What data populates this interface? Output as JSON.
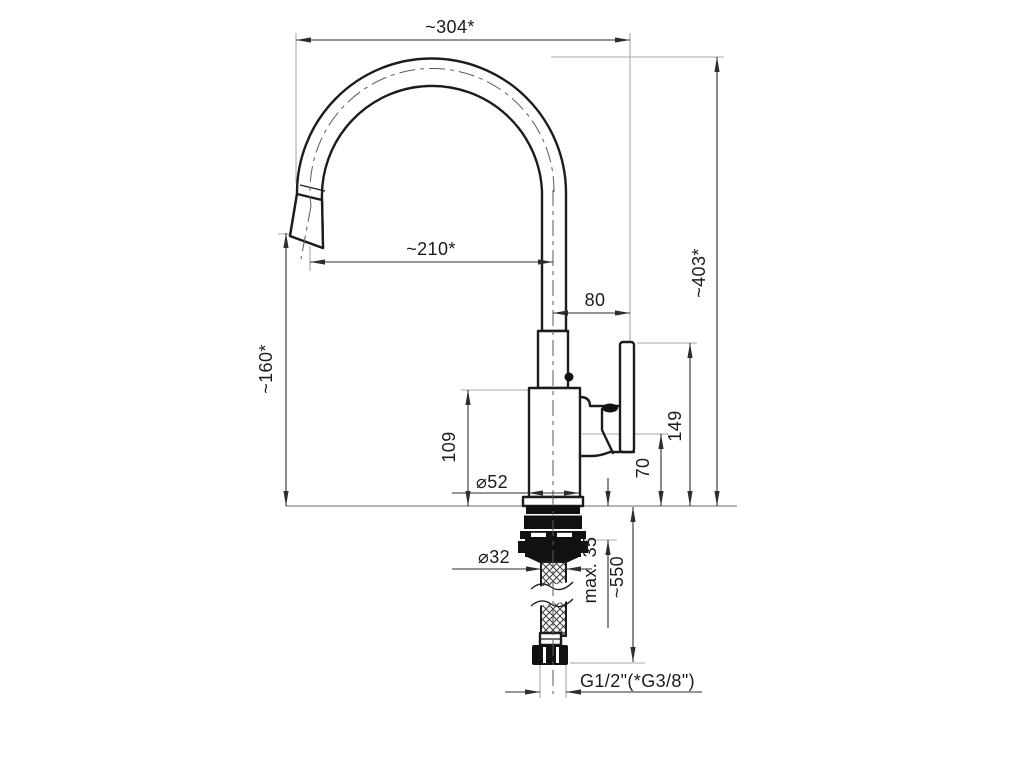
{
  "drawing": {
    "type": "technical-drawing",
    "subject": "single-lever kitchen faucet, side elevation with installation dimensions",
    "units": "mm",
    "dimensions": {
      "spout_projection": "~304*",
      "overall_height": "~403*",
      "spout_reach": "~210*",
      "spout_height": "~160*",
      "pipe_to_handle": "80",
      "handle_top_height": "149",
      "body_top_height": "109",
      "lever_pivot_height": "70",
      "base_diameter": "⌀52",
      "mounting_hole_diameter": "⌀32",
      "max_counter_thickness": "max. 35",
      "hose_length": "~550",
      "connection_thread": "G1/2\"(*G3/8\")"
    },
    "colors": {
      "outline": "#1c1c1c",
      "dimension_lines": "#2e2e2e",
      "extension_lines": "#a9a9a9",
      "background": "#ffffff"
    }
  }
}
